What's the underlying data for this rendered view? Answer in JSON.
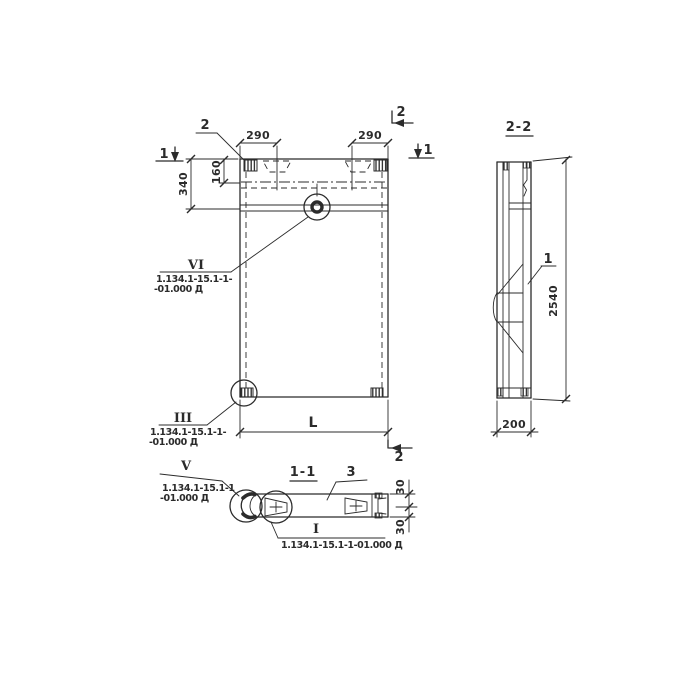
{
  "drawing": {
    "ink_color": "#2b2b2b",
    "paper_color": "#ffffff",
    "front_view": {
      "dim_290_left": "290",
      "dim_290_right": "290",
      "dim_340": "340",
      "dim_160": "160",
      "dim_length": "L",
      "detail_2_label": "2",
      "section_mark_1_left": "1",
      "section_mark_1_right": "1",
      "section_mark_2_top": "2",
      "section_mark_2_bottom": "2",
      "callout_vi": {
        "mark": "VI",
        "ref_line1": "1.134.1-15.1-1-",
        "ref_line2": "-01.000 Д"
      },
      "callout_iii": {
        "mark": "III",
        "ref_line1": "1.134.1-15.1-1-",
        "ref_line2": "-01.000 Д"
      }
    },
    "side_view": {
      "title": "2-2",
      "part_1_label": "1",
      "dim_height": "2540",
      "dim_width": "200"
    },
    "section_view": {
      "title": "1-1",
      "part_3_label": "3",
      "dim_30_top": "30",
      "dim_30_bottom": "30",
      "callout_v": {
        "mark": "V",
        "ref_line1": "1.134.1-15.1-1",
        "ref_line2": "-01.000 Д"
      },
      "callout_i": {
        "mark": "I",
        "ref": "1.134.1-15.1-1-01.000 Д"
      }
    }
  }
}
